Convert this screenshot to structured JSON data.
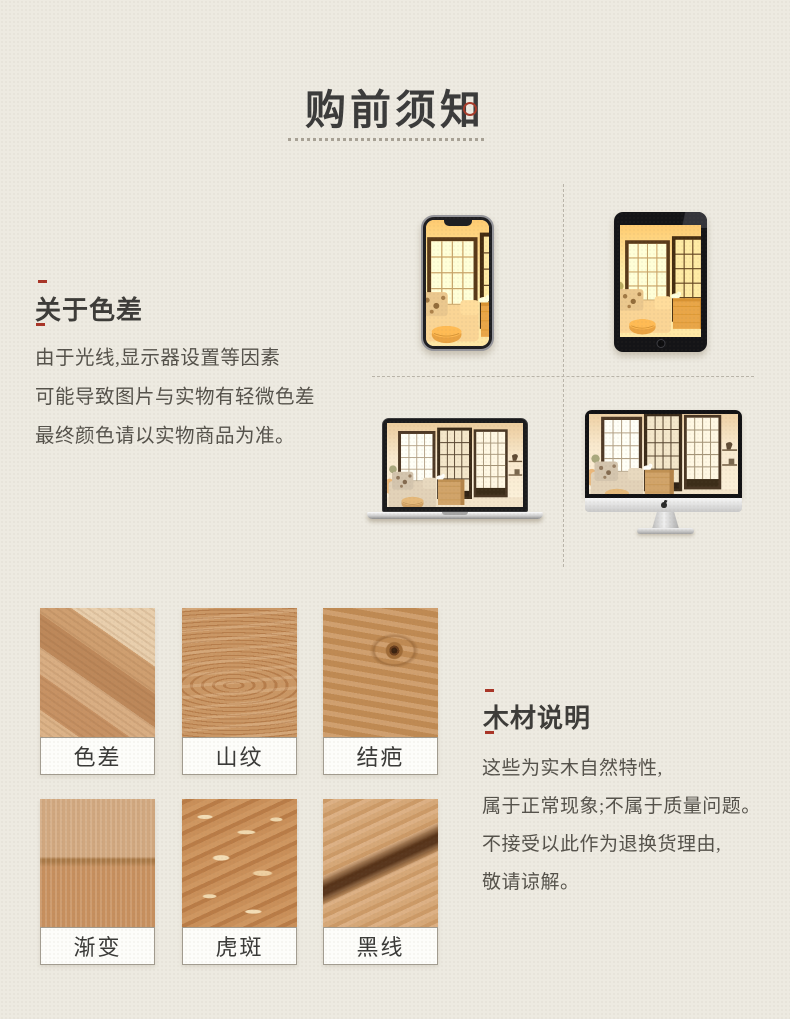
{
  "page": {
    "background": "#edeae1",
    "accent_red": "#a93527",
    "title_color": "#3b3b3b"
  },
  "header": {
    "title": "购前须知"
  },
  "icons": {
    "title_seal": "red-circle-seal",
    "apple_logo": "apple-logo"
  },
  "color_note": {
    "heading": "关于色差",
    "lines": [
      "由于光线,显示器设置等因素",
      "可能导致图片与实物有轻微色差",
      "最终颜色请以实物商品为准。"
    ]
  },
  "devices": {
    "items": [
      {
        "name": "smartphone"
      },
      {
        "name": "tablet"
      },
      {
        "name": "laptop"
      },
      {
        "name": "desktop-monitor"
      }
    ]
  },
  "wood_note": {
    "heading": "木材说明",
    "lines": [
      "这些为实木自然特性,",
      "属于正常现象;不属于质量问题。",
      "不接受以此作为退换货理由,",
      "敬请谅解。"
    ]
  },
  "swatches": [
    {
      "label": "色差"
    },
    {
      "label": "山纹"
    },
    {
      "label": "结疤"
    },
    {
      "label": "渐变"
    },
    {
      "label": "虎斑"
    },
    {
      "label": "黑线"
    }
  ]
}
